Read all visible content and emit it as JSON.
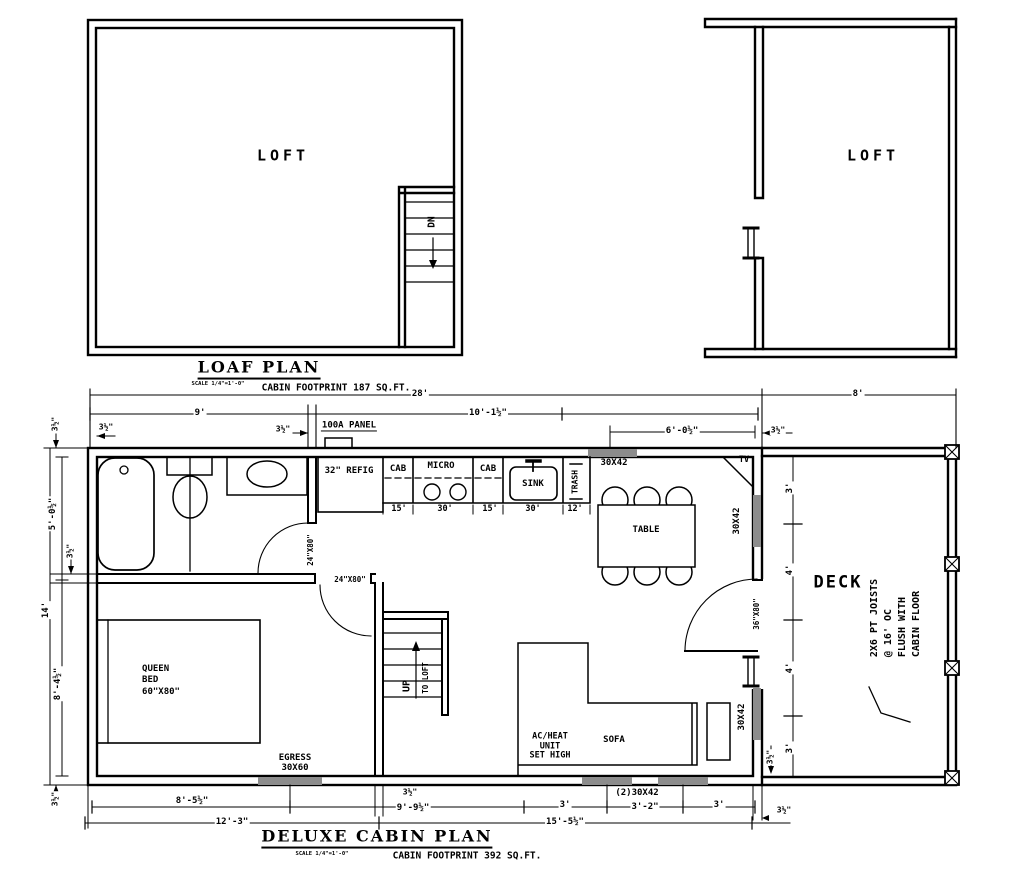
{
  "drawing_colors": {
    "line": "#000000",
    "window_fill": "#8c8c8c",
    "paper": "#ffffff"
  },
  "loft_plan": {
    "title": "LOAF PLAN",
    "scale": "SCALE 1/4\"=1'-0\"",
    "footprint": "CABIN FOOTPRINT 187 SQ.FT."
  },
  "cabin_plan": {
    "title": "DELUXE CABIN PLAN",
    "scale": "SCALE 1/4\"=1'-0\"",
    "footprint": "CABIN FOOTPRINT 392 SQ.FT."
  },
  "labels": [
    {
      "n": "loft1-room-label",
      "t": "LOFT",
      "x": 283,
      "y": 156,
      "s": 15,
      "ls": 4
    },
    {
      "n": "loft1-dn-label",
      "t": "DN",
      "x": 433,
      "y": 222,
      "s": 9.5,
      "r": -90
    },
    {
      "n": "loaf-plan-title",
      "t": "LOAF PLAN",
      "x": 259,
      "y": 369,
      "s": 16,
      "serif": 1,
      "ls": 2,
      "u": 1
    },
    {
      "n": "loaf-plan-scale",
      "t": "SCALE 1/4\"=1'-0\"",
      "x": 218,
      "y": 384,
      "s": 5.5
    },
    {
      "n": "loaf-plan-footprint",
      "t": "CABIN FOOTPRINT 187 SQ.FT.",
      "x": 336,
      "y": 389,
      "s": 9.5
    },
    {
      "n": "loft2-room-label",
      "t": "LOFT",
      "x": 873,
      "y": 156,
      "s": 15,
      "ls": 4
    },
    {
      "n": "dim-overall-28",
      "t": "28'",
      "x": 420,
      "y": 394,
      "s": 9,
      "bg": 1
    },
    {
      "n": "dim-deck-8",
      "t": "8'",
      "x": 858,
      "y": 394,
      "s": 9,
      "bg": 1
    },
    {
      "n": "dim-9",
      "t": "9'",
      "x": 200,
      "y": 413,
      "s": 9,
      "bg": 1
    },
    {
      "n": "dim-10-1h",
      "t": "10'-1½\"",
      "x": 488,
      "y": 413,
      "s": 9,
      "bg": 1
    },
    {
      "n": "dim-3h-top-left",
      "t": "3½\"",
      "x": 106,
      "y": 428,
      "s": 8,
      "bg": 1
    },
    {
      "n": "dim-3h-panel",
      "t": "3½\"",
      "x": 283,
      "y": 430,
      "s": 8,
      "bg": 1
    },
    {
      "n": "panel-label",
      "t": "100A PANEL",
      "x": 349,
      "y": 426,
      "s": 9,
      "u2": 1,
      "bg": 1
    },
    {
      "n": "dim-6-0h",
      "t": "6'-0½\"",
      "x": 682,
      "y": 431,
      "s": 9,
      "bg": 1
    },
    {
      "n": "dim-3h-top-right",
      "t": "3½\"",
      "x": 778,
      "y": 431,
      "s": 8,
      "bg": 1
    },
    {
      "n": "dim-3h-left-a",
      "t": "3½\"",
      "x": 56,
      "y": 424,
      "s": 8,
      "r": -90,
      "bg": 1
    },
    {
      "n": "dim-5-0h",
      "t": "5'-0½\"",
      "x": 53,
      "y": 514,
      "s": 9,
      "r": -90,
      "bg": 1
    },
    {
      "n": "dim-3h-left-b",
      "t": "3½\"",
      "x": 71,
      "y": 551,
      "s": 8,
      "r": -90,
      "bg": 1
    },
    {
      "n": "dim-14",
      "t": "14'",
      "x": 46,
      "y": 610,
      "s": 9,
      "r": -90,
      "bg": 1
    },
    {
      "n": "dim-8-4h",
      "t": "8'-4½\"",
      "x": 58,
      "y": 684,
      "s": 9,
      "r": -90,
      "bg": 1
    },
    {
      "n": "dim-3h-left-c",
      "t": "3½\"",
      "x": 56,
      "y": 799,
      "s": 8,
      "r": -90,
      "bg": 1
    },
    {
      "n": "dim-8-5h",
      "t": "8'-5½\"",
      "x": 192,
      "y": 801,
      "s": 9,
      "bg": 1
    },
    {
      "n": "dim-12-3",
      "t": "12'-3\"",
      "x": 232,
      "y": 822,
      "s": 9,
      "bg": 1
    },
    {
      "n": "dim-3h-stair",
      "t": "3½\"",
      "x": 410,
      "y": 793,
      "s": 8,
      "bg": 1
    },
    {
      "n": "dim-9-9h",
      "t": "9'-9½\"",
      "x": 413,
      "y": 808,
      "s": 9,
      "bg": 1
    },
    {
      "n": "dim-3-a",
      "t": "3'",
      "x": 565,
      "y": 805,
      "s": 9,
      "bg": 1
    },
    {
      "n": "window-2-30x42-label",
      "t": "(2)30X42",
      "x": 637,
      "y": 793,
      "s": 9,
      "bg": 1
    },
    {
      "n": "dim-3-2",
      "t": "3'-2\"",
      "x": 645,
      "y": 807,
      "s": 9,
      "bg": 1
    },
    {
      "n": "dim-3-b",
      "t": "3'",
      "x": 719,
      "y": 805,
      "s": 9,
      "bg": 1
    },
    {
      "n": "dim-15-5h",
      "t": "15'-5½\"",
      "x": 565,
      "y": 822,
      "s": 9,
      "bg": 1
    },
    {
      "n": "dim-3h-bottom-right",
      "t": "3½\"",
      "x": 784,
      "y": 811,
      "s": 8,
      "bg": 1
    },
    {
      "n": "deluxe-plan-title",
      "t": "DELUXE CABIN PLAN",
      "x": 377,
      "y": 838,
      "s": 16,
      "serif": 1,
      "ls": 2,
      "u": 1
    },
    {
      "n": "deluxe-plan-scale",
      "t": "SCALE 1/4\"=1'-0\"",
      "x": 322,
      "y": 854,
      "s": 5.5
    },
    {
      "n": "deluxe-plan-footprint",
      "t": "CABIN FOOTPRINT 392 SQ.FT.",
      "x": 467,
      "y": 857,
      "s": 9.5
    },
    {
      "n": "refrigerator-label",
      "t": "32\" REFIG",
      "x": 349,
      "y": 471,
      "s": 9
    },
    {
      "n": "cabinet-label-1",
      "t": "CAB",
      "x": 398,
      "y": 469,
      "s": 9
    },
    {
      "n": "microwave-label",
      "t": "MICRO",
      "x": 441,
      "y": 466,
      "s": 9
    },
    {
      "n": "cabinet-label-2",
      "t": "CAB",
      "x": 488,
      "y": 469,
      "s": 9
    },
    {
      "n": "sink-label",
      "t": "SINK",
      "x": 533,
      "y": 484,
      "s": 9
    },
    {
      "n": "trash-label",
      "t": "TRASH",
      "x": 576,
      "y": 482,
      "s": 8,
      "r": -90
    },
    {
      "n": "dim-cab1-15",
      "t": "15'",
      "x": 399,
      "y": 510,
      "s": 8.5
    },
    {
      "n": "dim-micro-30",
      "t": "30'",
      "x": 445,
      "y": 510,
      "s": 8.5
    },
    {
      "n": "dim-cab2-15",
      "t": "15'",
      "x": 490,
      "y": 510,
      "s": 8.5
    },
    {
      "n": "dim-sink-30",
      "t": "30'",
      "x": 533,
      "y": 510,
      "s": 8.5
    },
    {
      "n": "dim-trash-12",
      "t": "12'",
      "x": 575,
      "y": 510,
      "s": 8.5
    },
    {
      "n": "window-30x42-top-label",
      "t": "30X42",
      "x": 614,
      "y": 463,
      "s": 9
    },
    {
      "n": "tv-label",
      "t": "TV",
      "x": 744,
      "y": 461,
      "s": 8.5
    },
    {
      "n": "table-label",
      "t": "TABLE",
      "x": 646,
      "y": 530,
      "s": 9,
      "bg": 1
    },
    {
      "n": "window-30x42-right1-label",
      "t": "30X42",
      "x": 737,
      "y": 521,
      "s": 9,
      "r": -90,
      "bg": 1
    },
    {
      "n": "door-36x80-label",
      "t": "36\"X80\"",
      "x": 757,
      "y": 614,
      "s": 7.5,
      "r": -90,
      "bg": 1
    },
    {
      "n": "window-30x42-right2-label",
      "t": "30X42",
      "x": 742,
      "y": 717,
      "s": 9,
      "r": -90,
      "bg": 1
    },
    {
      "n": "deck-label",
      "t": "DECK",
      "x": 838,
      "y": 583,
      "s": 17,
      "ls": 2
    },
    {
      "n": "dim-deck-3-top",
      "t": "3'",
      "x": 790,
      "y": 488,
      "s": 9,
      "r": -90,
      "bg": 1
    },
    {
      "n": "dim-deck-4-top",
      "t": "4'",
      "x": 790,
      "y": 570,
      "s": 9,
      "r": -90,
      "bg": 1
    },
    {
      "n": "dim-deck-4-bottom",
      "t": "4'",
      "x": 790,
      "y": 668,
      "s": 9,
      "r": -90,
      "bg": 1
    },
    {
      "n": "dim-deck-3-bottom",
      "t": "3'",
      "x": 790,
      "y": 748,
      "s": 9,
      "r": -90,
      "bg": 1
    },
    {
      "n": "dim-deck-3h",
      "t": "3½\"",
      "x": 771,
      "y": 757,
      "s": 8,
      "r": -90,
      "bg": 1
    },
    {
      "n": "deck-joist-note",
      "t": "2X6 PT JOISTS\n@ 16' OC\nFLUSH WITH\nCABIN FLOOR",
      "x": 896,
      "y": 618,
      "s": 10,
      "r": -90,
      "al": "left",
      "lh": 1.4
    },
    {
      "n": "ac-heat-note",
      "t": "AC/HEAT\nUNIT\nSET HIGH",
      "x": 550,
      "y": 747,
      "s": 8.5
    },
    {
      "n": "sofa-label",
      "t": "SOFA",
      "x": 614,
      "y": 740,
      "s": 9
    },
    {
      "n": "queen-bed-label",
      "t": "QUEEN\nBED\n60\"X80\"",
      "x": 161,
      "y": 681,
      "s": 9,
      "al": "left",
      "lh": 1.25
    },
    {
      "n": "egress-window-label",
      "t": "EGRESS\n30X60",
      "x": 295,
      "y": 763,
      "s": 9
    },
    {
      "n": "door-24x80-bedroom-label",
      "t": "24\"X80\"",
      "x": 350,
      "y": 580,
      "s": 7.5,
      "bg": 1
    },
    {
      "n": "door-24x80-bath-label",
      "t": "24\"X80\"",
      "x": 311,
      "y": 550,
      "s": 7.5,
      "r": -90,
      "bg": 1
    },
    {
      "n": "stairs-up-label",
      "t": "UP",
      "x": 407,
      "y": 686,
      "s": 10,
      "r": -90
    },
    {
      "n": "stairs-to-loft-label",
      "t": "TO LOFT",
      "x": 426,
      "y": 678,
      "s": 7.5,
      "r": -90
    }
  ]
}
